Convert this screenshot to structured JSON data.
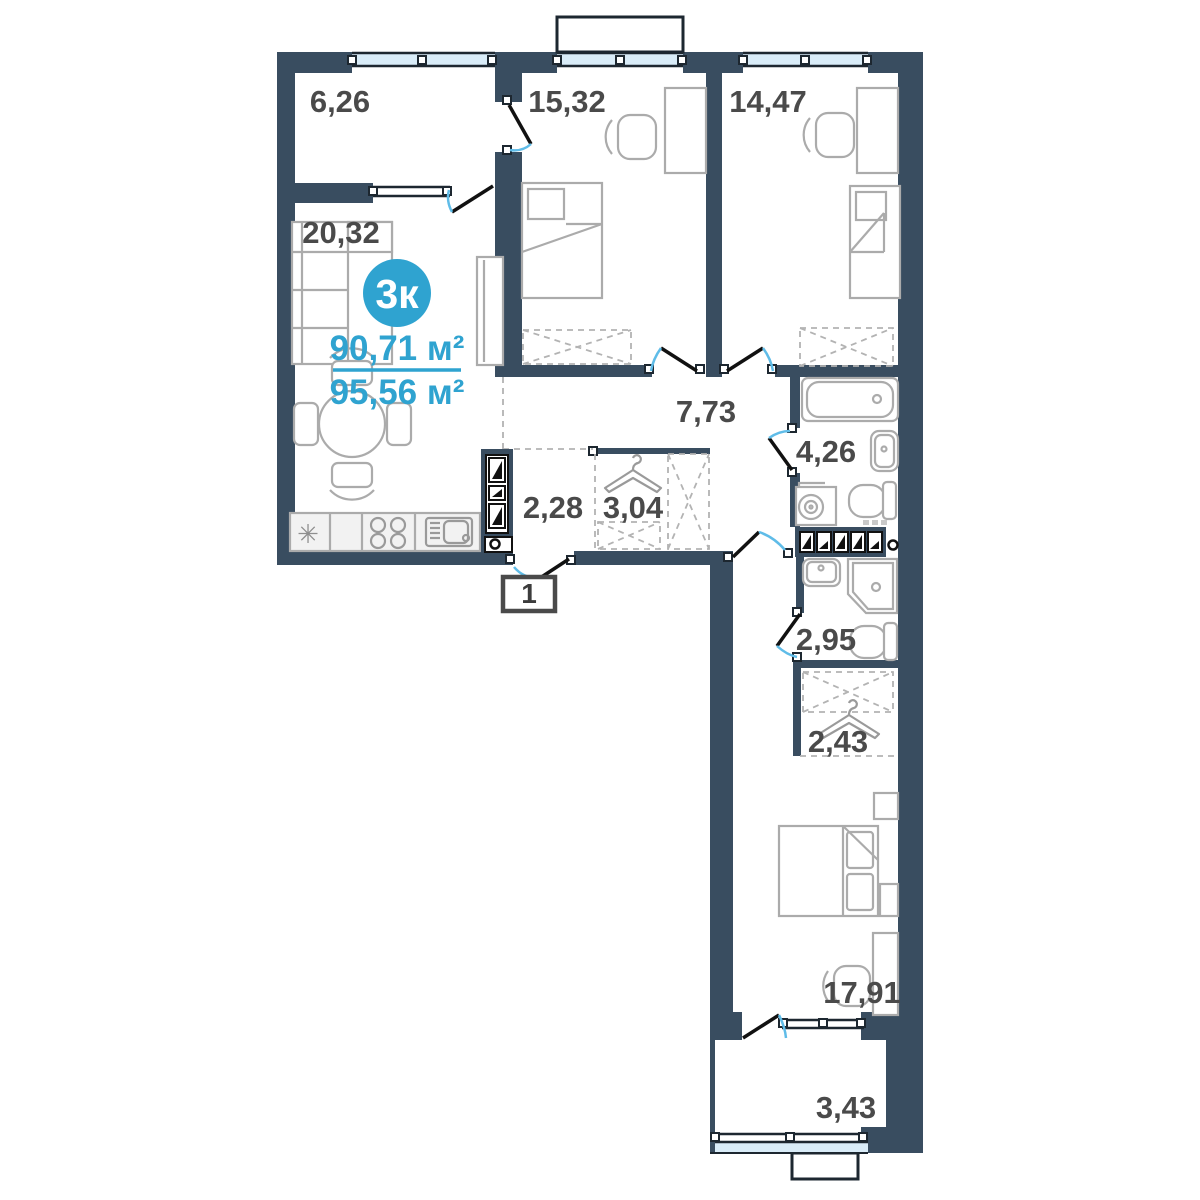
{
  "plan": {
    "badge": "3к",
    "area_living": "90,71 м²",
    "area_total": "95,56 м²",
    "entrance_number": "1",
    "icons": {
      "fridge_symbol": "✳"
    },
    "rooms": [
      {
        "id": "loggia-top",
        "area": "6,26"
      },
      {
        "id": "bedroom-1",
        "area": "15,32"
      },
      {
        "id": "bedroom-2",
        "area": "14,47"
      },
      {
        "id": "living-kitchen",
        "area": "20,32"
      },
      {
        "id": "hallway",
        "area": "7,73"
      },
      {
        "id": "bathroom",
        "area": "4,26"
      },
      {
        "id": "entry-hall",
        "area": "2,28"
      },
      {
        "id": "wardrobe-entry",
        "area": "3,04"
      },
      {
        "id": "shower-room",
        "area": "2,95"
      },
      {
        "id": "wardrobe",
        "area": "2,43"
      },
      {
        "id": "bedroom-3",
        "area": "17,91"
      },
      {
        "id": "loggia-bottom",
        "area": "3,43"
      }
    ],
    "colors": {
      "wall": "#394D60",
      "accent": "#2FA3D0",
      "glass": "#D9ECF8",
      "door_arc": "#5FBCE8",
      "furniture": "#ABABAB",
      "label": "#4A4A4A"
    }
  }
}
